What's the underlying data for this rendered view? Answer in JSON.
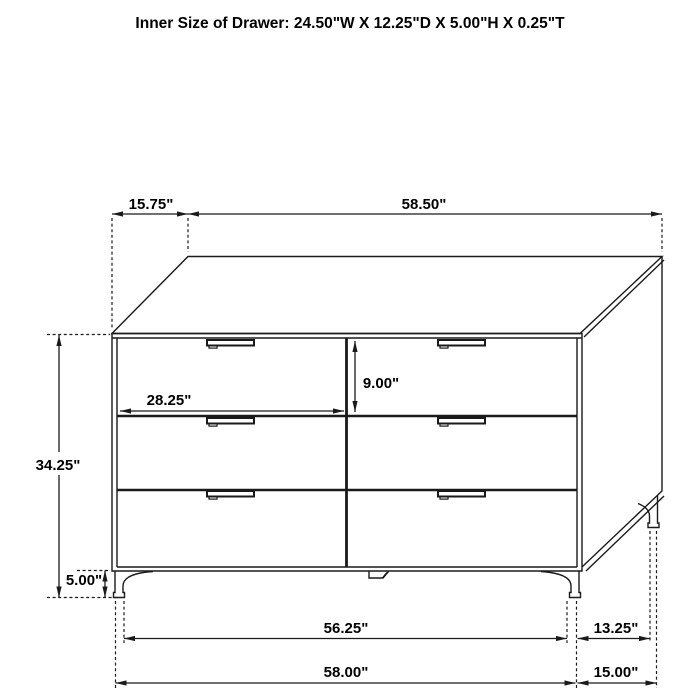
{
  "title": "Inner Size of Drawer: 24.50\"W X 12.25\"D X 5.00\"H X 0.25\"T",
  "dimensions": {
    "top_depth": "15.75\"",
    "top_width": "58.50\"",
    "overall_height": "34.25\"",
    "leg_height": "5.00\"",
    "drawer_inner_width": "28.25\"",
    "drawer_face_height": "9.00\"",
    "base_front_inner_width": "56.25\"",
    "base_side_inner_depth": "13.25\"",
    "base_front_overall_width": "58.00\"",
    "base_side_overall_depth": "15.00\""
  },
  "colors": {
    "line": "#1a1a1a",
    "text": "#000000",
    "background": "#ffffff"
  }
}
